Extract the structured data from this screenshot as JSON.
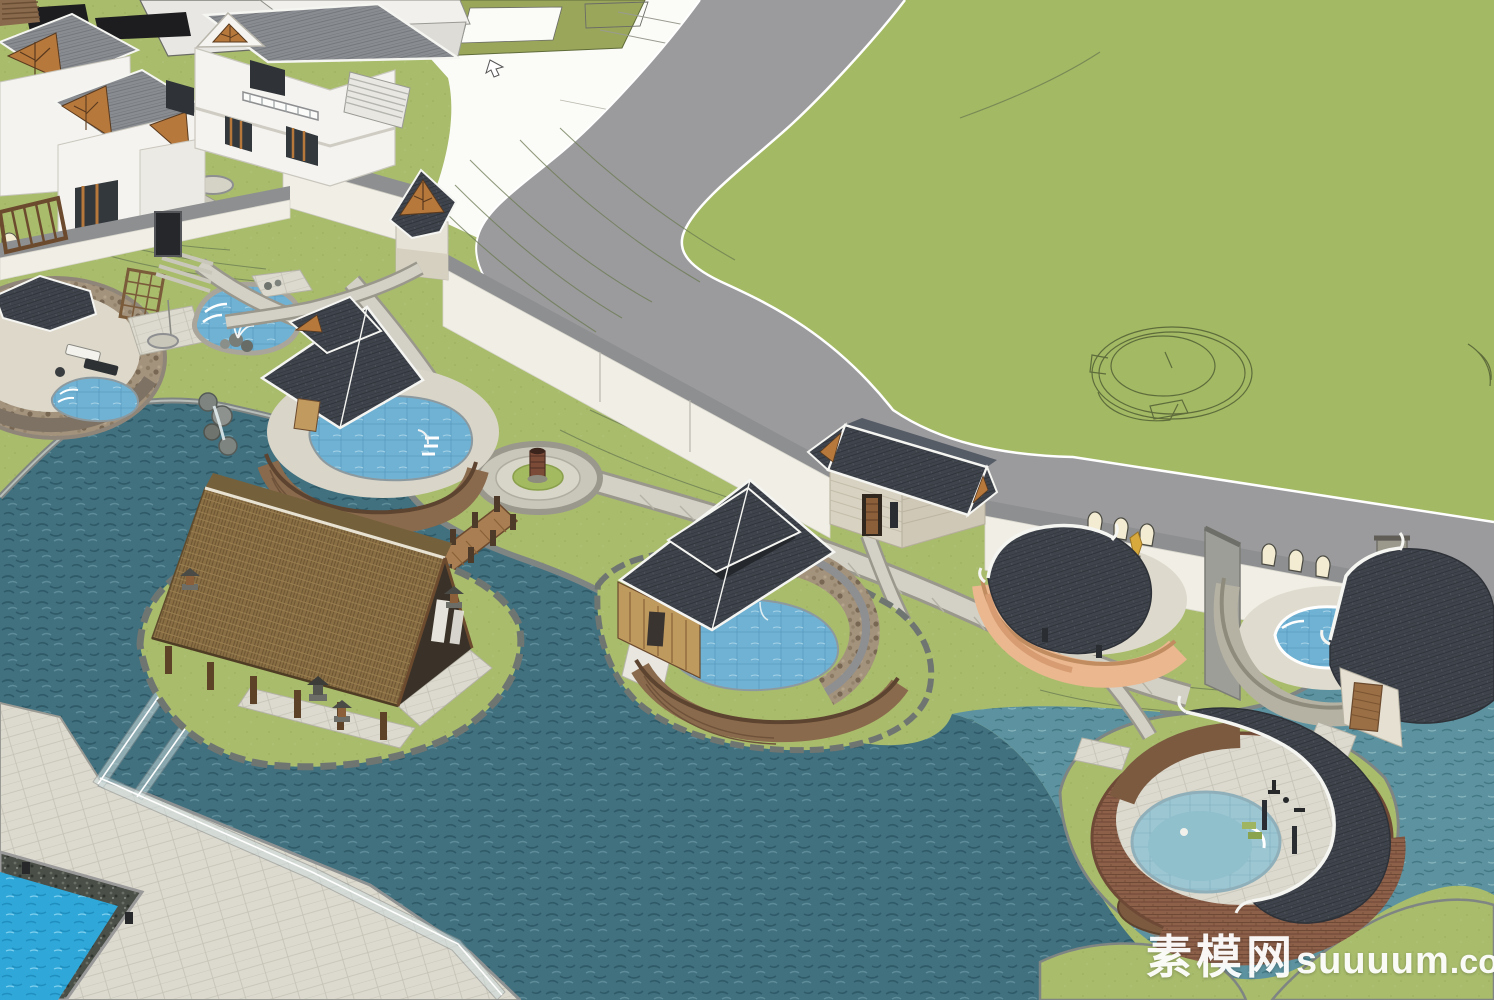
{
  "watermark": {
    "site_name_cn": "素模网",
    "site_name_latin": "suuuum",
    "site_tld": ".com"
  },
  "palette": {
    "grass": "#a8bc6c",
    "field_grass": "#a3b963",
    "contour_line": "#6b7a52",
    "road": "#9b9b9d",
    "road_edge": "#ffffff",
    "white_plane": "#fbfbf8",
    "flat_roof_olive": "#9aa75b",
    "wall_face": "#f0eee5",
    "wall_cap": "#8e8f91",
    "pond_water": "#41707f",
    "channel_water": "#5d93a0",
    "pool_blue": "#6fb2d4",
    "bright_pool_blue": "#2fa7d8",
    "pale_pool": "#9cc6d2",
    "dark_roof": "#3f444c",
    "villa_roof": "#898c90",
    "roof_fascia": "#f5f5f2",
    "thatch_roof": "#8a6f45",
    "wood_slat": "#8a6a4c",
    "light_wood": "#bf9a5f",
    "orange_spa_wall": "#eab78f",
    "brick_wall": "#8d6049",
    "beige_wall": "#d8d2c2",
    "gable_wood": "#b7783c",
    "paving": "#dcd9ce",
    "plaza_paving": "#c9c6ba",
    "stone_edge": "#7e8583",
    "glass_rail": "#cfdede",
    "mulch_brown": "#7b5a40",
    "statue_gold": "#d8a93c"
  },
  "scene": {
    "elements": [
      "villa-cluster",
      "courtyard-wall",
      "gate-tower-pavilion",
      "perimeter-wall",
      "arched-niches",
      "ring-road",
      "big-lawn-field",
      "layout-wireframe-circle",
      "cursor-arrow",
      "left-stone-spa",
      "trellis-screen",
      "freeform-fountain-pool",
      "rock-waterfall",
      "pool-pavilion-one",
      "circular-plaza",
      "plaza-sculpture",
      "wood-bridge",
      "thatch-pavilion-island",
      "stone-lanterns",
      "day-bed",
      "pool-pavilion-two",
      "stone-arc-wall",
      "gatehouse",
      "orange-fan-spa",
      "fountain-statue",
      "gray-curved-spa",
      "round-brick-spa",
      "crescent-roof",
      "mulch-circle",
      "pond",
      "water-channels",
      "glass-rail-walkways",
      "corner-lap-pool",
      "pebble-border",
      "watermark"
    ]
  }
}
